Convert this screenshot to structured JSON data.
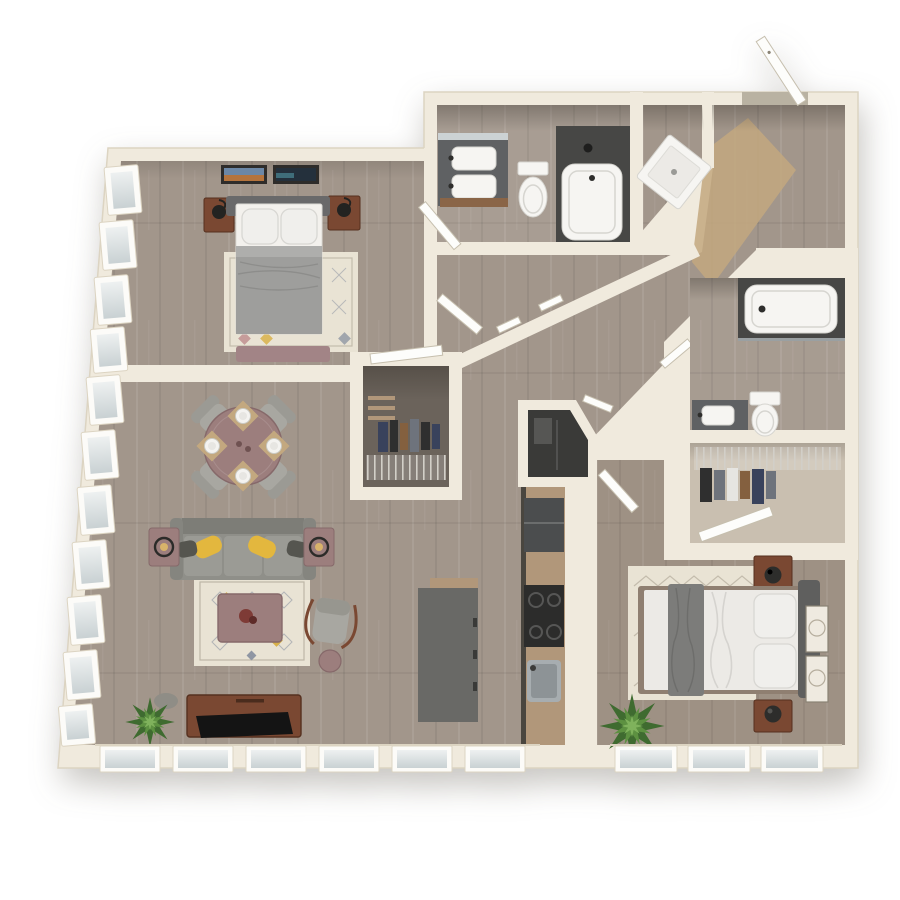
{
  "meta": {
    "title": "3D top-view floor plan of a two-bedroom, two-bathroom apartment",
    "style": "photoreal 3D render, no text labels",
    "bedrooms": 2,
    "bathrooms": 2
  },
  "colors": {
    "wall": "#f0eadd",
    "wallLine": "#dcd4c2",
    "floor": "#a2968b",
    "floorBath": "#ab9f93",
    "closetFloor": "#6b635b",
    "laundryFloor": "#3a3a38",
    "tan": "#c3a87f",
    "rug": "#e9e3d4",
    "rugLine": "#b3ab9b",
    "rugYellow": "#d8b14a",
    "rugPink": "#c08f8f",
    "rugGray": "#8f96a3",
    "mauve": "#9c7e7d",
    "mauveDark": "#86696a",
    "brown": "#7a4832",
    "brownDark": "#55301f",
    "sofa": "#8f8f89",
    "sofaDark": "#7d7d77",
    "seat": "#9b9b95",
    "yellow": "#e3b73e",
    "pillowDark": "#55554f",
    "chair": "#a8a7a1",
    "bedGray": "#9e9e9c",
    "bedGrayLight": "#aeaeac",
    "headboard": "#69696a",
    "pillow": "#f0efec",
    "pillowShade": "#d8d7d3",
    "duvet": "#eceae6",
    "throw": "#7c7c7a",
    "island": "#69696 6",
    "islandBody": "#696966",
    "counterWood": "#b1977a",
    "appliance": "#2c2c2b",
    "fridge": "#4b4d4e",
    "steel": "#a7adb0",
    "tubDark": "#474745",
    "fixture": "#f6f5f2",
    "fixtureShade": "#d6d5d0",
    "frame": "#fcfbf8",
    "doorLeaf": "#fdfdfb",
    "doorEdge": "#c6bfae",
    "glassA": "#eef1f1",
    "glassB": "#c9d1d3",
    "plantA": "#3f6b30",
    "plantB": "#5d9141",
    "plantC": "#7fb25c",
    "wire": "#d2cfc8",
    "clothNavy": "#39425c",
    "clothGray": "#6e737c",
    "clothWhite": "#e6e5e1",
    "clothBrown": "#84603f",
    "clothBlack": "#2f2f2f",
    "tv": "#141414",
    "artDark": "#2e2c2a"
  },
  "rooms": [
    {
      "id": "bedroom-1",
      "label": "Bedroom 1",
      "contents": [
        "bed with gray duvet",
        "2 wood nightstands",
        "2 black lamps",
        "patterned cream rug",
        "mauve bench",
        "2 framed pictures",
        "corner windows"
      ]
    },
    {
      "id": "bathroom-1",
      "label": "Bathroom 1",
      "contents": [
        "double-sink vanity",
        "mirror",
        "toilet",
        "tub with dark shower surround"
      ]
    },
    {
      "id": "shower-room",
      "label": "Shower room",
      "contents": [
        "corner shower pan"
      ]
    },
    {
      "id": "entry",
      "label": "Entry",
      "contents": [
        "open entry door",
        "tan runner"
      ]
    },
    {
      "id": "hallway",
      "label": "Diagonal hallway",
      "contents": [
        "hall doors"
      ]
    },
    {
      "id": "hall-closet",
      "label": "Hall closet",
      "contents": [
        "hanging clothes",
        "wire shelving",
        "wood shelves"
      ]
    },
    {
      "id": "laundry-closet",
      "label": "Utility closet",
      "contents": [
        "dark interior"
      ]
    },
    {
      "id": "dining-area",
      "label": "Dining area",
      "contents": [
        "round mauve table",
        "4 gray chairs",
        "4 place settings"
      ]
    },
    {
      "id": "living-room",
      "label": "Living room",
      "contents": [
        "gray sofa",
        "yellow throw pillows",
        "2 mauve side tables with lamps",
        "patterned rug",
        "mauve coffee table",
        "accent chair",
        "round ottoman",
        "media console with TV",
        "plant",
        "decorative rock"
      ]
    },
    {
      "id": "kitchen",
      "label": "Kitchen",
      "contents": [
        "refrigerator",
        "cooktop",
        "sink",
        "wood counter",
        "gray island"
      ]
    },
    {
      "id": "bathroom-2",
      "label": "Bathroom 2",
      "contents": [
        "tub with dark surround",
        "toilet",
        "vanity with sink"
      ]
    },
    {
      "id": "walk-in-closet",
      "label": "Walk-in closet",
      "contents": [
        "wire shelf",
        "hanging clothes"
      ]
    },
    {
      "id": "bedroom-2",
      "label": "Bedroom 2",
      "contents": [
        "bed with white duvet and gray throw",
        "2 wood nightstands",
        "2 dark lamps",
        "zigzag cream rug",
        "2 framed pictures",
        "plant"
      ]
    }
  ],
  "windows": {
    "left_wall_panes": 11,
    "bottom_wall_panes": 9
  }
}
